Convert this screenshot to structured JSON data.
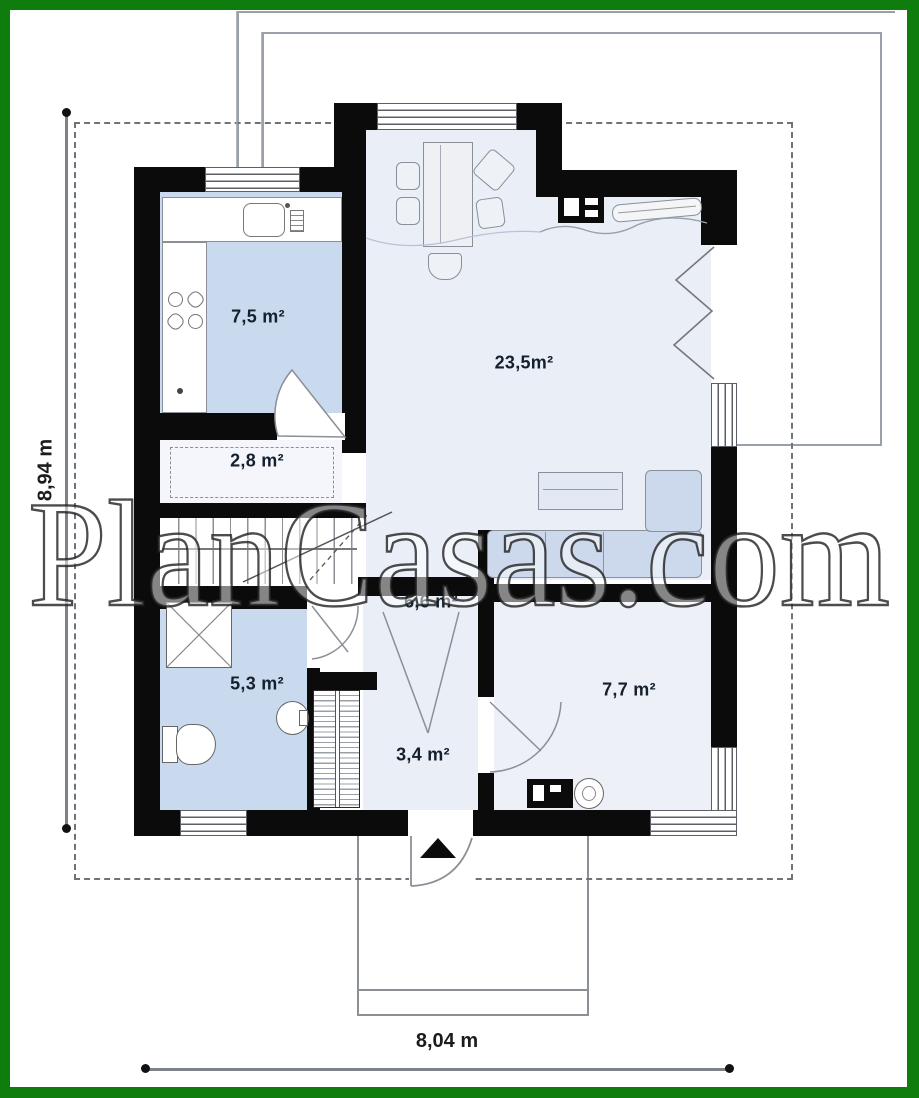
{
  "title": "House ground floor plan",
  "watermark": {
    "text": "PlanCasas.com"
  },
  "rooms": {
    "kitchen": {
      "name": "kitchen",
      "area_label": "7,5 m²"
    },
    "living": {
      "name": "living-room",
      "area_label": "23,5m²"
    },
    "closet": {
      "name": "closet",
      "area_label": "2,8 m²"
    },
    "hall": {
      "name": "hall",
      "area_label": "6,6 m²"
    },
    "bathroom": {
      "name": "bathroom",
      "area_label": "5,3 m²"
    },
    "entry": {
      "name": "entry-hall",
      "area_label": "3,4 m²"
    },
    "bedroom": {
      "name": "room",
      "area_label": "7,7 m²"
    }
  },
  "dimensions": {
    "height_label": "8,94 m",
    "width_label": "8,04 m"
  },
  "colors": {
    "frame_green": "#0e7d0e",
    "wall_black": "#0b0b0b",
    "room_blue": "#c9daee",
    "room_light": "#e9eef7",
    "room_pale": "#f4f6fb",
    "label_text": "#15202f"
  },
  "icons": {
    "entrance_arrow": "black triangle marking main entrance",
    "north_lines": "terrace and porch outlines"
  }
}
